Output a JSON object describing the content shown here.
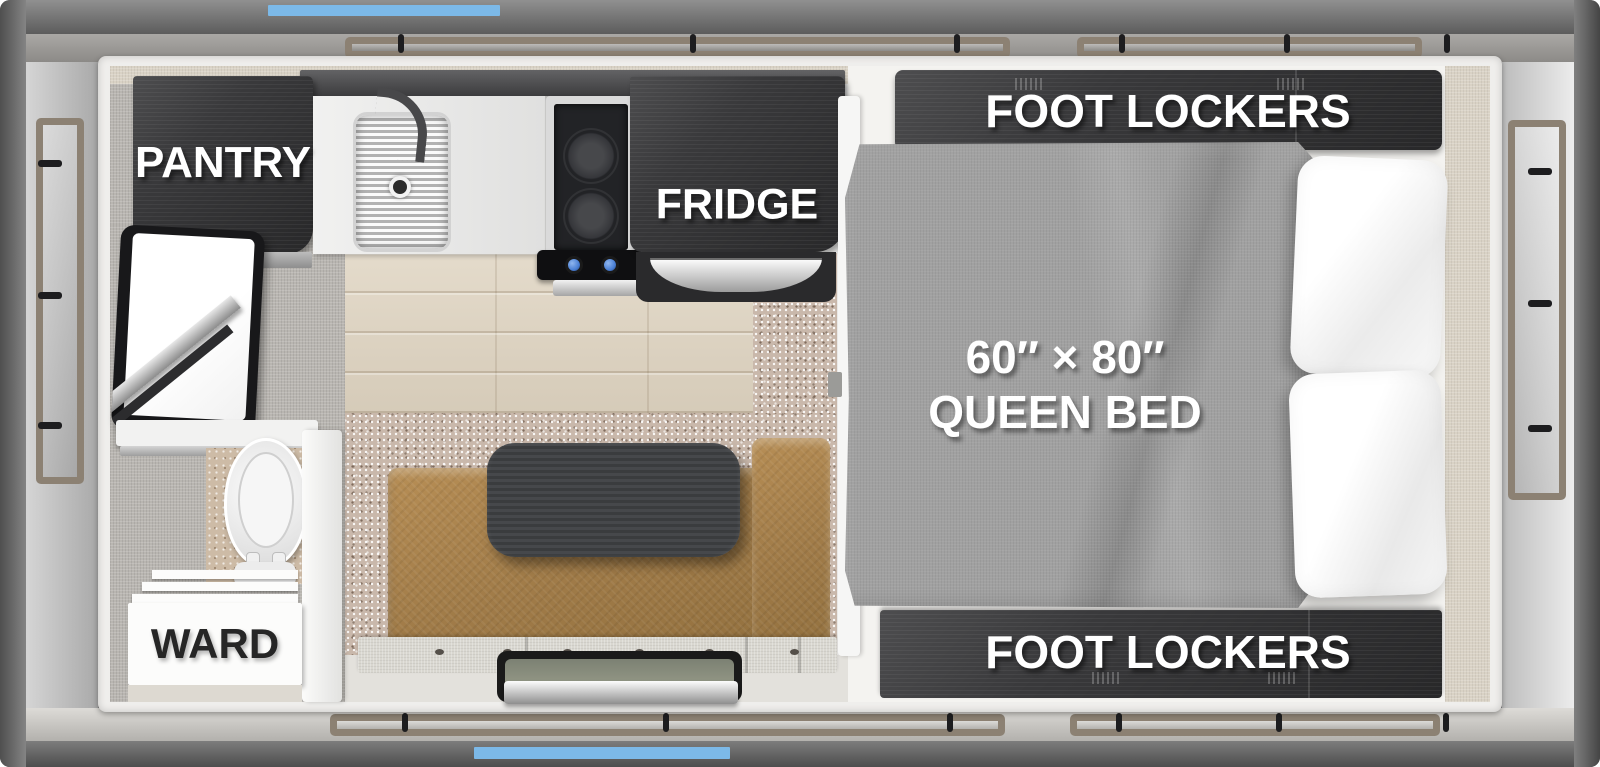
{
  "floorplan": {
    "labels": {
      "pantry": "PANTRY",
      "fridge": "FRIDGE",
      "foot_lockers_top": "FOOT LOCKERS",
      "foot_lockers_bottom": "FOOT LOCKERS",
      "wardrobe": "WARD",
      "bed_size": "60″ × 80″",
      "bed_type": "QUEEN BED"
    },
    "colors": {
      "accent_blue": "#7cb9e8",
      "frame_gray": "#6f6f6f",
      "cabinet_dark_wood": "#39393b",
      "bench_tan_leather": "#a9834f",
      "blanket_gray": "#a1a1a1",
      "wood_floor_beige": "#dbd1c0",
      "carpet_taupe": "#c9b8ab",
      "stove_knob_blue": "#4a7fd4",
      "awning_trim_tan": "#8c8173"
    },
    "fixtures": [
      "pantry-cabinet",
      "kitchen-sink",
      "faucet",
      "two-burner-stove",
      "fridge-cabinet",
      "tv",
      "toilet",
      "wardrobe",
      "dinette-table",
      "bench-seat",
      "entry-window",
      "queen-bed",
      "pillows",
      "foot-locker-cabinets"
    ]
  }
}
